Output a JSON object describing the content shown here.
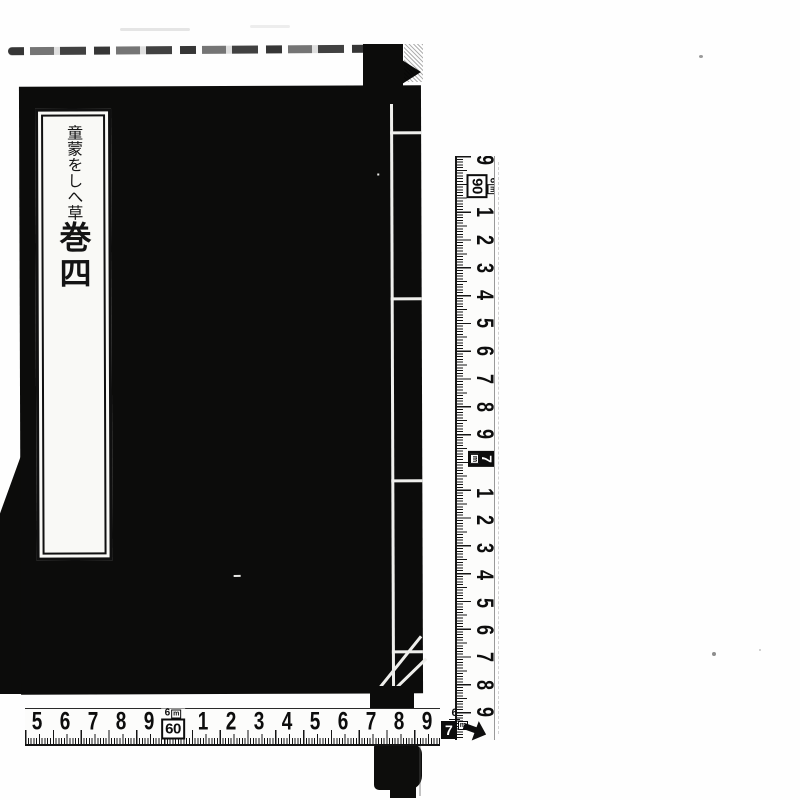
{
  "colors": {
    "ink": "#0c0c0b",
    "paper": "#fefefe",
    "thread": "#efefec"
  },
  "book": {
    "title_label": {
      "title": "童蒙をしへ草",
      "volume": "巻四"
    }
  },
  "rulers": {
    "vertical": {
      "partial_top_number": "9",
      "meter_box_top": {
        "meter": "6",
        "unit": "m",
        "centimeters": "90"
      },
      "numbers_upper": [
        "1",
        "2",
        "3",
        "4",
        "5",
        "6",
        "7",
        "8",
        "9"
      ],
      "meter_box_mid": {
        "meters": "7",
        "unit": "m"
      },
      "numbers_lower": [
        "1",
        "2",
        "3",
        "4",
        "5",
        "6",
        "7",
        "8",
        "9"
      ]
    },
    "horizontal": {
      "numbers_left": [
        "5",
        "6",
        "7",
        "8",
        "9"
      ],
      "meter_box": {
        "meter": "6",
        "unit": "m",
        "centimeters": "60"
      },
      "numbers_mid": [
        "1",
        "2",
        "3",
        "4",
        "5",
        "6",
        "7",
        "8",
        "9"
      ],
      "end_box": {
        "meter": "6",
        "centimeters": "7",
        "unit": "m"
      }
    }
  }
}
